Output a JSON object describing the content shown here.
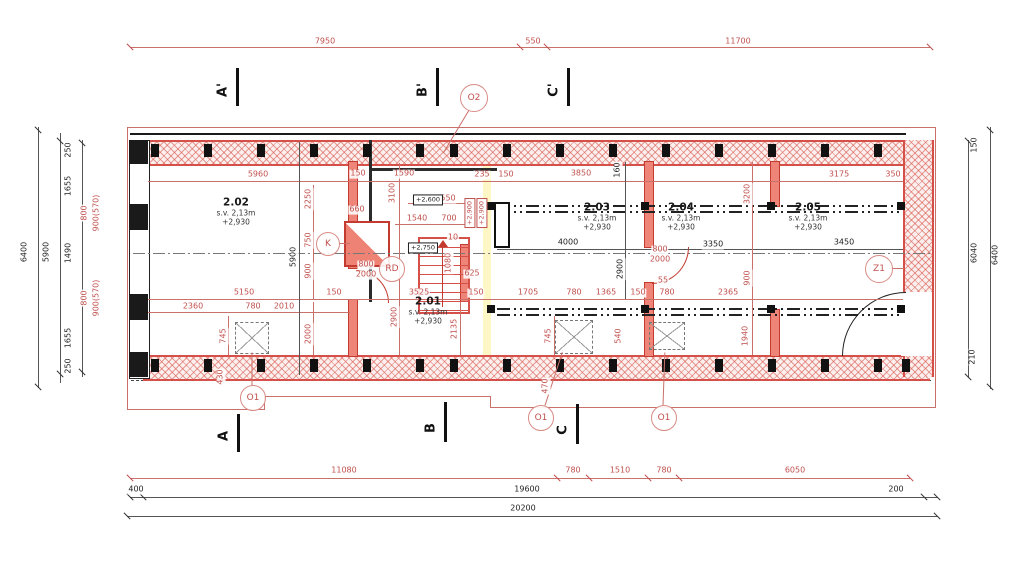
{
  "drawing": {
    "rooms": [
      {
        "number": "2.02",
        "height": "s.v. 2,13m",
        "level": "+2,930",
        "x": 236,
        "y": 212
      },
      {
        "number": "2.01",
        "height": "s.v. 2,13m",
        "level": "+2,930",
        "x": 428,
        "y": 311
      },
      {
        "number": "2.03",
        "height": "s.v. 2,13m",
        "level": "+2,930",
        "x": 597,
        "y": 217
      },
      {
        "number": "2.04",
        "height": "s.v. 2,13m",
        "level": "+2,930",
        "x": 681,
        "y": 217
      },
      {
        "number": "2.05",
        "height": "s.v. 2,13m",
        "level": "+2,930",
        "x": 808,
        "y": 217
      }
    ],
    "callouts": [
      {
        "label": "O2",
        "x": 473,
        "y": 97,
        "r": 13
      },
      {
        "label": "K",
        "x": 327,
        "y": 243,
        "r": 11
      },
      {
        "label": "RD",
        "x": 391,
        "y": 268,
        "r": 12
      },
      {
        "label": "Z1",
        "x": 878,
        "y": 268,
        "r": 13
      },
      {
        "label": "O1",
        "x": 252,
        "y": 397,
        "r": 12
      },
      {
        "label": "O1",
        "x": 540,
        "y": 417,
        "r": 12
      },
      {
        "label": "O1",
        "x": 663,
        "y": 417,
        "r": 12
      }
    ],
    "sections": [
      {
        "label": "A'",
        "barX": 237,
        "barY": 68,
        "barH": 38,
        "lx": 223,
        "ly": 90
      },
      {
        "label": "B'",
        "barX": 437,
        "barY": 68,
        "barH": 38,
        "lx": 423,
        "ly": 90
      },
      {
        "label": "C'",
        "barX": 568,
        "barY": 68,
        "barH": 38,
        "lx": 554,
        "ly": 90
      },
      {
        "label": "A",
        "barX": 238,
        "barY": 414,
        "barH": 38,
        "lx": 224,
        "ly": 436
      },
      {
        "label": "B",
        "barX": 445,
        "barY": 402,
        "barH": 40,
        "lx": 431,
        "ly": 428
      },
      {
        "label": "C",
        "barX": 577,
        "barY": 404,
        "barH": 40,
        "lx": 563,
        "ly": 430
      }
    ],
    "dimensions": [
      {
        "t": "7950",
        "x": 325,
        "y": 42
      },
      {
        "t": "550",
        "x": 533,
        "y": 42
      },
      {
        "t": "11700",
        "x": 738,
        "y": 42
      },
      {
        "t": "6400",
        "x": 25,
        "y": 252,
        "v": 1,
        "k": 1
      },
      {
        "t": "5900",
        "x": 47,
        "y": 252,
        "v": 1,
        "k": 1
      },
      {
        "t": "250",
        "x": 69,
        "y": 150,
        "v": 1,
        "k": 1
      },
      {
        "t": "1655",
        "x": 69,
        "y": 186,
        "v": 1,
        "k": 1
      },
      {
        "t": "1490",
        "x": 69,
        "y": 253,
        "v": 1,
        "k": 1
      },
      {
        "t": "1655",
        "x": 69,
        "y": 338,
        "v": 1,
        "k": 1
      },
      {
        "t": "250",
        "x": 69,
        "y": 366,
        "v": 1,
        "k": 1
      },
      {
        "t": "800",
        "x": 85,
        "y": 213,
        "v": 1
      },
      {
        "t": "900(570)",
        "x": 97,
        "y": 213,
        "v": 1
      },
      {
        "t": "800",
        "x": 85,
        "y": 298,
        "v": 1
      },
      {
        "t": "900(570)",
        "x": 97,
        "y": 298,
        "v": 1
      },
      {
        "t": "150",
        "x": 975,
        "y": 145,
        "v": 1,
        "k": 1
      },
      {
        "t": "6040",
        "x": 975,
        "y": 253,
        "v": 1,
        "k": 1
      },
      {
        "t": "6400",
        "x": 996,
        "y": 255,
        "v": 1,
        "k": 1
      },
      {
        "t": "210",
        "x": 973,
        "y": 357,
        "v": 1,
        "k": 1
      },
      {
        "t": "11080",
        "x": 344,
        "y": 471
      },
      {
        "t": "780",
        "x": 573,
        "y": 471
      },
      {
        "t": "1510",
        "x": 620,
        "y": 471
      },
      {
        "t": "780",
        "x": 664,
        "y": 471
      },
      {
        "t": "6050",
        "x": 795,
        "y": 471
      },
      {
        "t": "400",
        "x": 136,
        "y": 490,
        "k": 1
      },
      {
        "t": "19600",
        "x": 527,
        "y": 490,
        "k": 1
      },
      {
        "t": "200",
        "x": 896,
        "y": 490,
        "k": 1
      },
      {
        "t": "20200",
        "x": 523,
        "y": 509,
        "k": 1
      },
      {
        "t": "5960",
        "x": 258,
        "y": 175
      },
      {
        "t": "150",
        "x": 358,
        "y": 174
      },
      {
        "t": "1590",
        "x": 404,
        "y": 174
      },
      {
        "t": "235",
        "x": 482,
        "y": 175
      },
      {
        "t": "150",
        "x": 506,
        "y": 175
      },
      {
        "t": "3850",
        "x": 581,
        "y": 174
      },
      {
        "t": "3175",
        "x": 839,
        "y": 175
      },
      {
        "t": "350",
        "x": 893,
        "y": 175
      },
      {
        "t": "160",
        "x": 618,
        "y": 170,
        "v": 1,
        "k": 1
      },
      {
        "t": "2250",
        "x": 309,
        "y": 199,
        "v": 1
      },
      {
        "t": "750",
        "x": 309,
        "y": 240,
        "v": 1
      },
      {
        "t": "900",
        "x": 309,
        "y": 271,
        "v": 1
      },
      {
        "t": "5900",
        "x": 294,
        "y": 257,
        "v": 1,
        "k": 1
      },
      {
        "t": "660",
        "x": 357,
        "y": 210
      },
      {
        "t": "3100",
        "x": 393,
        "y": 193,
        "v": 1
      },
      {
        "t": "550",
        "x": 448,
        "y": 199
      },
      {
        "t": "1540",
        "x": 417,
        "y": 219
      },
      {
        "t": "700",
        "x": 449,
        "y": 219
      },
      {
        "t": "10",
        "x": 453,
        "y": 238
      },
      {
        "t": "1080",
        "x": 449,
        "y": 263,
        "v": 1
      },
      {
        "t": "625",
        "x": 472,
        "y": 274
      },
      {
        "t": "800",
        "x": 366,
        "y": 265
      },
      {
        "t": "2000",
        "x": 366,
        "y": 275
      },
      {
        "t": "4000",
        "x": 568,
        "y": 243,
        "k": 1
      },
      {
        "t": "3350",
        "x": 713,
        "y": 245,
        "k": 1
      },
      {
        "t": "3450",
        "x": 844,
        "y": 243,
        "k": 1
      },
      {
        "t": "3200",
        "x": 748,
        "y": 194,
        "v": 1
      },
      {
        "t": "2900",
        "x": 621,
        "y": 269,
        "v": 1,
        "k": 1
      },
      {
        "t": "800",
        "x": 660,
        "y": 250
      },
      {
        "t": "2000",
        "x": 660,
        "y": 260
      },
      {
        "t": "55",
        "x": 663,
        "y": 281
      },
      {
        "t": "900",
        "x": 748,
        "y": 278,
        "v": 1
      },
      {
        "t": "5150",
        "x": 244,
        "y": 293
      },
      {
        "t": "150",
        "x": 334,
        "y": 293
      },
      {
        "t": "3525",
        "x": 419,
        "y": 293
      },
      {
        "t": "150",
        "x": 476,
        "y": 293
      },
      {
        "t": "1705",
        "x": 528,
        "y": 293
      },
      {
        "t": "780",
        "x": 574,
        "y": 293
      },
      {
        "t": "1365",
        "x": 606,
        "y": 293
      },
      {
        "t": "150",
        "x": 638,
        "y": 293
      },
      {
        "t": "780",
        "x": 667,
        "y": 293
      },
      {
        "t": "2365",
        "x": 728,
        "y": 293
      },
      {
        "t": "2360",
        "x": 193,
        "y": 307
      },
      {
        "t": "780",
        "x": 253,
        "y": 307
      },
      {
        "t": "2010",
        "x": 284,
        "y": 307
      },
      {
        "t": "745",
        "x": 224,
        "y": 336,
        "v": 1
      },
      {
        "t": "2000",
        "x": 309,
        "y": 334,
        "v": 1
      },
      {
        "t": "2900",
        "x": 395,
        "y": 317,
        "v": 1
      },
      {
        "t": "2135",
        "x": 455,
        "y": 329,
        "v": 1
      },
      {
        "t": "745",
        "x": 549,
        "y": 336,
        "v": 1
      },
      {
        "t": "540",
        "x": 619,
        "y": 336,
        "v": 1
      },
      {
        "t": "1940",
        "x": 746,
        "y": 336,
        "v": 1
      },
      {
        "t": "430",
        "x": 221,
        "y": 377,
        "v": 1
      },
      {
        "t": "470",
        "x": 546,
        "y": 386,
        "v": 1
      },
      {
        "t": "+2,600",
        "x": 428,
        "y": 200,
        "box": 1,
        "k": 1
      },
      {
        "t": "+2,750",
        "x": 423,
        "y": 248,
        "box": 1,
        "k": 1
      },
      {
        "t": "+2,900",
        "x": 470,
        "y": 213,
        "box": 1,
        "v": 1
      },
      {
        "t": "+2,900",
        "x": 482,
        "y": 213,
        "box": 1,
        "v": 1
      }
    ],
    "colors": {
      "wall_red": "#d6504a",
      "dim_red": "#c0504d",
      "black": "#1a1a1a",
      "highlight_yellow": "#faf3b8"
    }
  }
}
